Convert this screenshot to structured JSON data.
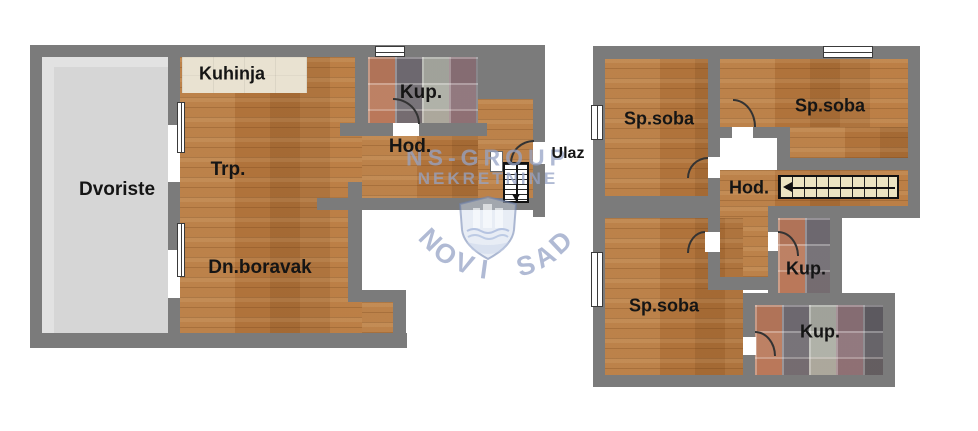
{
  "watermark": {
    "agency_line1": "NS-GROUP",
    "agency_line2": "NEKRETNINE",
    "city": "NOVI SAD"
  },
  "floor1": {
    "dvoriste": "Dvoriste",
    "kuhinja": "Kuhinja",
    "kup": "Kup.",
    "hod": "Hod.",
    "trp": "Trp.",
    "dn_boravak": "Dn.boravak",
    "ulaz": "Ulaz"
  },
  "floor2": {
    "sp_soba_1": "Sp.soba",
    "sp_soba_2": "Sp.soba",
    "sp_soba_3": "Sp.soba",
    "hod": "Hod.",
    "kup_1": "Kup.",
    "kup_2": "Kup."
  },
  "stairs": {
    "ground_floor_direction": "down",
    "upper_floor_direction": "left"
  },
  "colors": {
    "wall": "#7b7b7b",
    "yard": "#d6d6d6",
    "yard_light": "#e2e2e2",
    "wood": "#b5783f",
    "tile": "#8f8c88",
    "kitchen": "#e9e2d1",
    "stairs": "#ece4c2",
    "watermark": "#96a4c6",
    "label": "#151515"
  }
}
